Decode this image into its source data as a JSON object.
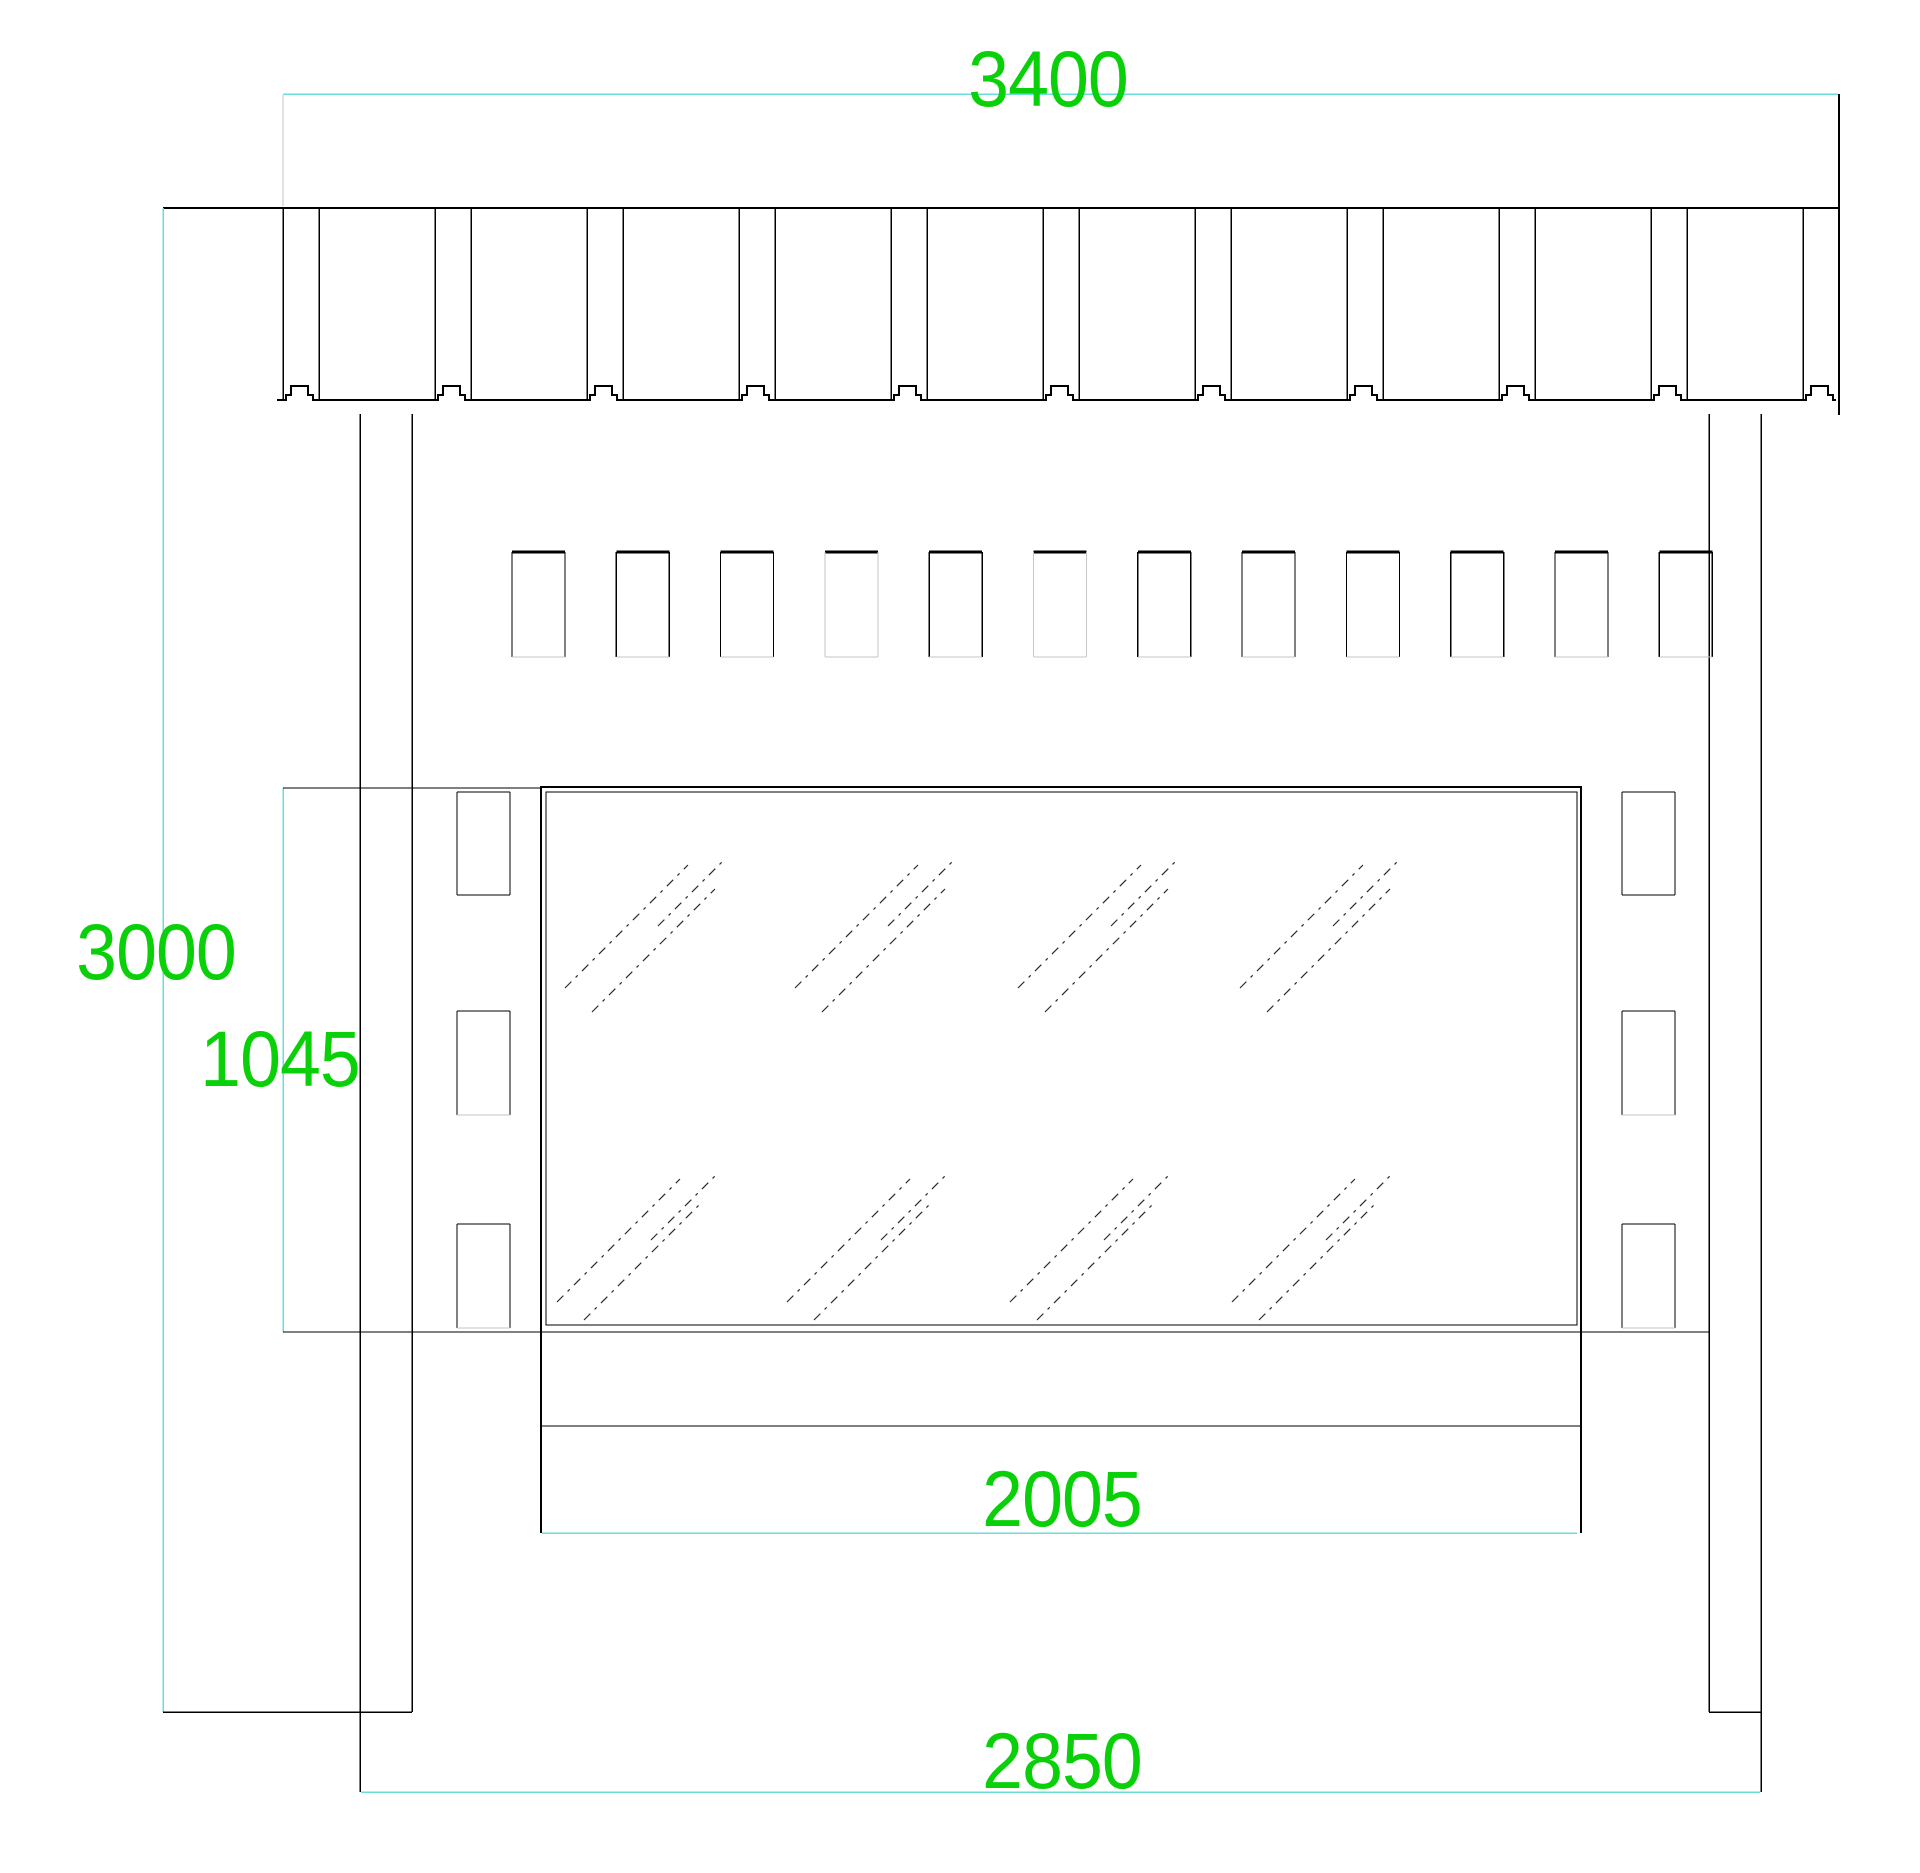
{
  "drawing_title": "shelter-elevation-cad-drawing",
  "canvas": {
    "width": 1920,
    "height": 1873,
    "background": "#ffffff"
  },
  "colors": {
    "line": "#000000",
    "faint": "#c6c6c6",
    "dim_line": "#6adcdc",
    "dim_text": "#0ad00a",
    "hatch": "#2a2a2a"
  },
  "labels": [
    {
      "name": "dim-label-3400",
      "value": "3400",
      "x": 1048,
      "y": 80
    },
    {
      "name": "dim-label-3000",
      "value": "3000",
      "x": 156,
      "y": 953
    },
    {
      "name": "dim-label-1045",
      "value": "1045",
      "x": 280,
      "y": 1060
    },
    {
      "name": "dim-label-2005",
      "value": "2005",
      "x": 1062,
      "y": 1500
    },
    {
      "name": "dim-label-2850",
      "value": "2850",
      "x": 1062,
      "y": 1762
    }
  ],
  "band": {
    "left": 163,
    "right": 1839,
    "top": 208,
    "bottom": 400,
    "bottom_start": 277,
    "bottom_end": 1836,
    "channels": [
      283,
      435,
      587,
      739,
      891,
      1043,
      1195,
      1347,
      1499,
      1651,
      1803
    ],
    "channel_width": 36,
    "notch": {
      "inset": 3,
      "step1_w": 5,
      "step1_h": 5,
      "step2_h": 9,
      "top_w": 17
    }
  },
  "vents": {
    "x0": 512,
    "pitch": 104.3,
    "count": 12,
    "slot_width": 53,
    "y_top": 552,
    "y_bottom": 657,
    "light_side_indices": [
      3,
      5
    ]
  },
  "clips": {
    "columns_x": [
      457,
      1622
    ],
    "width": 53,
    "rows_y": [
      [
        792,
        895
      ],
      [
        1011,
        1115
      ],
      [
        1224,
        1328
      ]
    ],
    "light_bottom_rows": [
      1,
      2
    ]
  },
  "sign": {
    "outer": {
      "x1": 540,
      "y1": 787,
      "x2": 1582,
      "y2": 1332
    },
    "glass": {
      "x1": 546,
      "y1": 792,
      "x2": 1577,
      "y2": 1325
    },
    "side_ext_bottom": 1533,
    "lower_panel_bottom": 1426
  },
  "lines": [
    {
      "x1": 283,
      "y1": 94,
      "x2": 1838,
      "y2": 94,
      "c": "dim_line",
      "w": 1.5
    },
    {
      "x1": 163,
      "y1": 208,
      "x2": 163,
      "y2": 1712,
      "c": "dim_line",
      "w": 1.5
    },
    {
      "x1": 283,
      "y1": 788,
      "x2": 283,
      "y2": 1332,
      "c": "dim_line",
      "w": 1.5
    },
    {
      "x1": 542,
      "y1": 1533,
      "x2": 1577,
      "y2": 1533,
      "c": "dim_line",
      "w": 1.5
    },
    {
      "x1": 361,
      "y1": 1792,
      "x2": 1760,
      "y2": 1792,
      "c": "dim_line",
      "w": 1.5
    },
    {
      "x1": 283,
      "y1": 95,
      "x2": 283,
      "y2": 206,
      "c": "faint",
      "w": 1
    },
    {
      "x1": 1839,
      "y1": 94,
      "x2": 1839,
      "y2": 415,
      "c": "line",
      "w": 1.6
    },
    {
      "x1": 283,
      "y1": 788,
      "x2": 540,
      "y2": 788,
      "c": "line",
      "w": 1.4
    },
    {
      "x1": 283,
      "y1": 1332,
      "x2": 1709,
      "y2": 1332,
      "c": "line",
      "w": 1.4
    },
    {
      "x1": 541,
      "y1": 1426,
      "x2": 1581,
      "y2": 1426,
      "c": "line",
      "w": 1.4
    },
    {
      "x1": 360,
      "y1": 414,
      "x2": 360,
      "y2": 1792,
      "c": "line",
      "w": 1.5
    },
    {
      "x1": 412,
      "y1": 414,
      "x2": 412,
      "y2": 1712,
      "c": "line",
      "w": 1.5
    },
    {
      "x1": 1709,
      "y1": 414,
      "x2": 1709,
      "y2": 1712,
      "c": "line",
      "w": 1.5
    },
    {
      "x1": 1761,
      "y1": 414,
      "x2": 1761,
      "y2": 1792,
      "c": "line",
      "w": 1.5
    },
    {
      "x1": 163,
      "y1": 1712,
      "x2": 412,
      "y2": 1712,
      "c": "line",
      "w": 1.5
    },
    {
      "x1": 1709,
      "y1": 1712,
      "x2": 1761,
      "y2": 1712,
      "c": "line",
      "w": 1.5
    },
    {
      "x1": 540,
      "y1": 787,
      "x2": 1582,
      "y2": 787,
      "c": "line",
      "w": 2
    },
    {
      "x1": 541,
      "y1": 787,
      "x2": 541,
      "y2": 1533,
      "c": "line",
      "w": 2
    },
    {
      "x1": 1581,
      "y1": 787,
      "x2": 1581,
      "y2": 1533,
      "c": "line",
      "w": 2
    }
  ],
  "hatch": {
    "color": "#2a2a2a",
    "width": 1.2,
    "dash": "9 6 3 6",
    "columns_x": [
      565,
      795,
      1018,
      1240
    ],
    "top_row": [
      [
        0,
        988,
        123,
        865
      ],
      [
        27,
        1012,
        150,
        889
      ],
      [
        93,
        926,
        158,
        861
      ]
    ],
    "bottom_row": [
      [
        -8,
        1302,
        115,
        1179
      ],
      [
        19,
        1320,
        136,
        1203
      ],
      [
        86,
        1240,
        151,
        1175
      ]
    ]
  }
}
